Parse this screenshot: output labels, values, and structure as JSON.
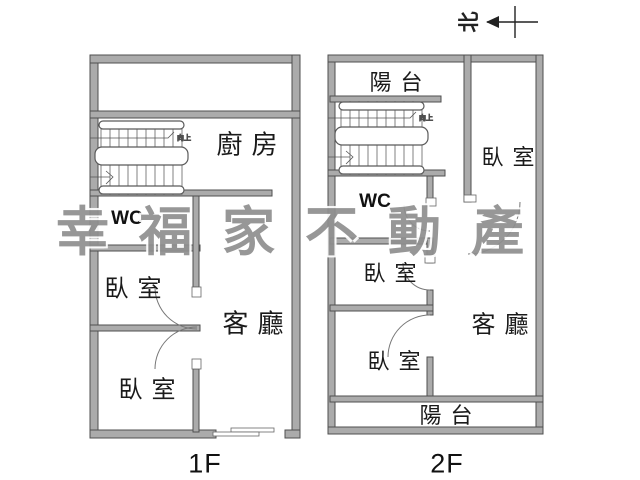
{
  "compass": {
    "north_label": "北"
  },
  "watermark": {
    "text": "幸福家不動產",
    "color": "#8f8f8f"
  },
  "stairs": {
    "up_label": "向上"
  },
  "floor1": {
    "caption": "1F",
    "rooms": {
      "kitchen": "廚房",
      "wc": "WC",
      "bedroom_upper": "臥室",
      "living": "客廳",
      "bedroom_lower": "臥室"
    }
  },
  "floor2": {
    "caption": "2F",
    "rooms": {
      "balcony_top": "陽台",
      "bedroom_right": "臥室",
      "wc": "WC",
      "bedroom_middle": "臥室",
      "living": "客廳",
      "bedroom_lower": "臥室",
      "balcony_bottom": "陽台"
    }
  },
  "colors": {
    "wall_fill": "#ababab",
    "wall_stroke": "#4f4f4f",
    "stair_line": "#777777"
  }
}
